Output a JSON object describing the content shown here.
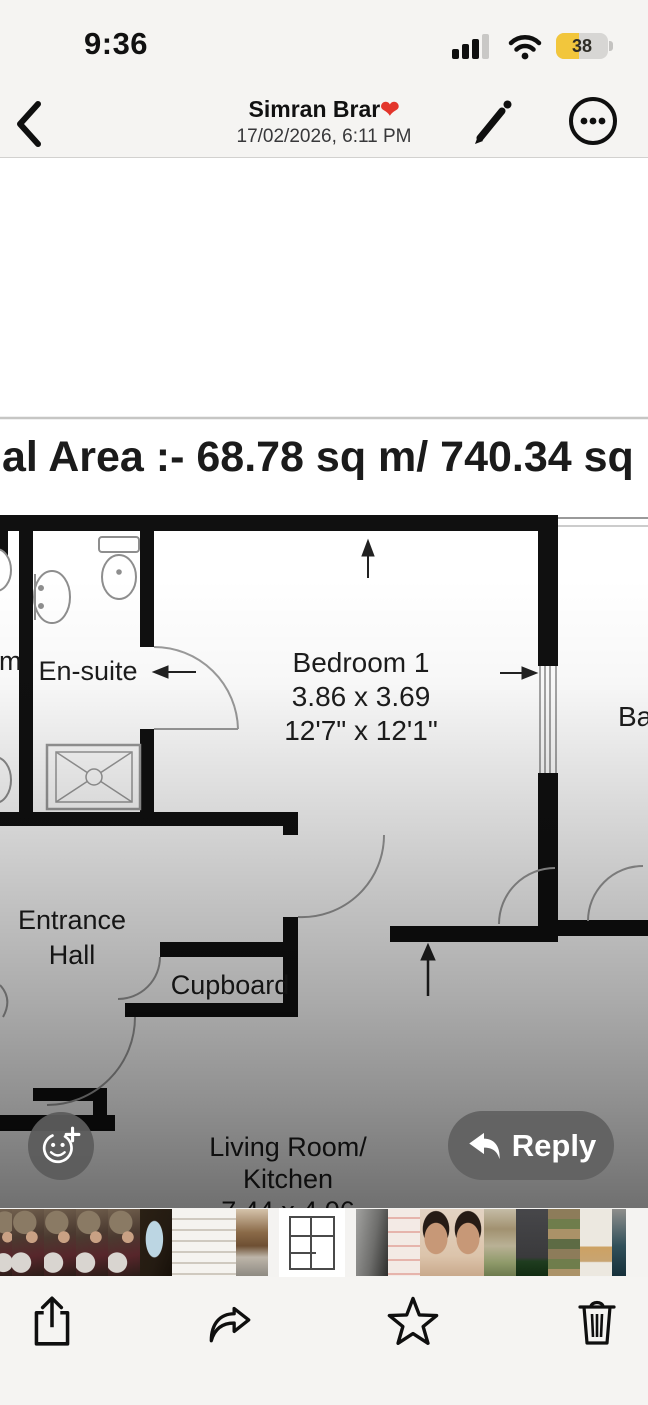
{
  "status_bar": {
    "time": "9:36",
    "battery_percent": "38",
    "battery_color": "#f2c63c",
    "icons": [
      "cellular-signal-icon",
      "wifi-icon",
      "battery-icon"
    ]
  },
  "nav": {
    "back_icon": "chevron-left",
    "title": "Simran Brar",
    "heart": "❤",
    "heart_color": "#e3352b",
    "subtitle": "17/02/2026, 6:11 PM",
    "edit_icon": "pencil-markup",
    "more_icon": "ellipsis-circle"
  },
  "floorplan": {
    "area_line": "al Area :-  68.78 sq m/ 740.34 sq",
    "left_room_partial": "m",
    "ensuite_label": "En-suite",
    "bedroom_label": "Bedroom 1",
    "bedroom_dim_m": "3.86 x 3.69",
    "bedroom_dim_ft": "12'7\" x 12'1\"",
    "balcony_partial": "Ba",
    "entrance_line1": "Entrance",
    "entrance_line2": "Hall",
    "cupboard_label": "Cupboard",
    "living_line1": "Living Room/",
    "living_line2": "Kitchen",
    "living_dim_partial": "7.44 x 4.06"
  },
  "overlay": {
    "reply_label": "Reply",
    "reaction_icon": "smiley-plus-tapback",
    "reply_icon": "reply-arrow"
  },
  "thumbnails": [
    {
      "kind": "people-edge"
    },
    {
      "kind": "people"
    },
    {
      "kind": "people"
    },
    {
      "kind": "people"
    },
    {
      "kind": "people"
    },
    {
      "kind": "dark-blue-doc"
    },
    {
      "kind": "white-doc"
    },
    {
      "kind": "white-doc"
    },
    {
      "kind": "room-photo"
    },
    {
      "kind": "floorplan-selected"
    },
    {
      "kind": "gray-doc"
    },
    {
      "kind": "pink-doc"
    },
    {
      "kind": "portrait"
    },
    {
      "kind": "portrait"
    },
    {
      "kind": "green-doc"
    },
    {
      "kind": "dark-doc"
    },
    {
      "kind": "stripe-doc"
    },
    {
      "kind": "light-doc"
    },
    {
      "kind": "teal-edge"
    }
  ],
  "toolbar": {
    "icons": [
      "share-icon",
      "forward-icon",
      "star-icon",
      "trash-icon"
    ]
  }
}
